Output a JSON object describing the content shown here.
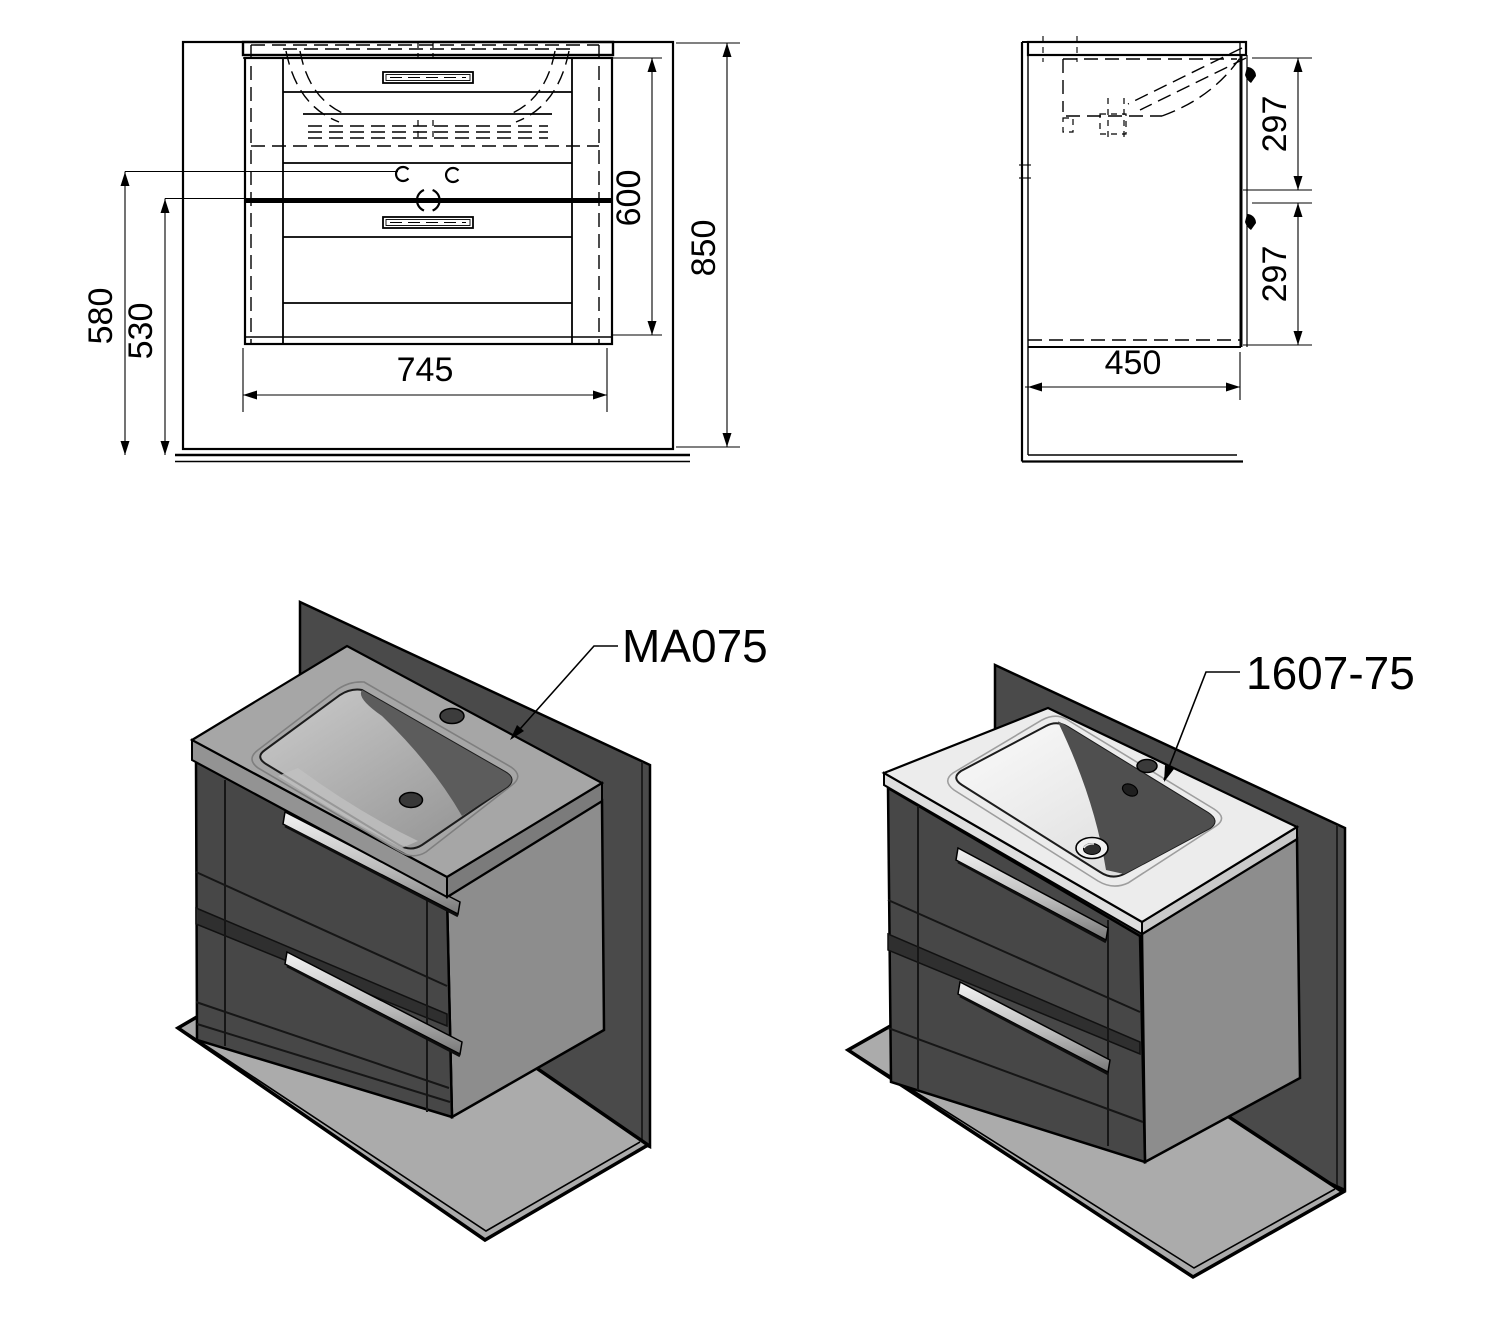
{
  "drawing": {
    "front_view": {
      "title": "front elevation",
      "dim_overall_height": "850",
      "dim_cabinet_height": "600",
      "dim_width": "745",
      "dim_height_total_left": "580",
      "dim_height_divider_left": "530"
    },
    "side_view": {
      "title": "side section",
      "dim_depth": "450",
      "dim_upper_drawer": "297",
      "dim_lower_drawer": "297"
    },
    "renders": {
      "left_label": "MA075",
      "right_label": "1607-75"
    },
    "colors": {
      "line": "#000000",
      "wall_dark": "#4a4a4a",
      "floor_gray": "#ababab",
      "cabinet_front": "#474747",
      "cabinet_side": "#8d8d8d",
      "basin_gray": "#a6a6a6",
      "ceramic_white": "#ececec"
    }
  }
}
